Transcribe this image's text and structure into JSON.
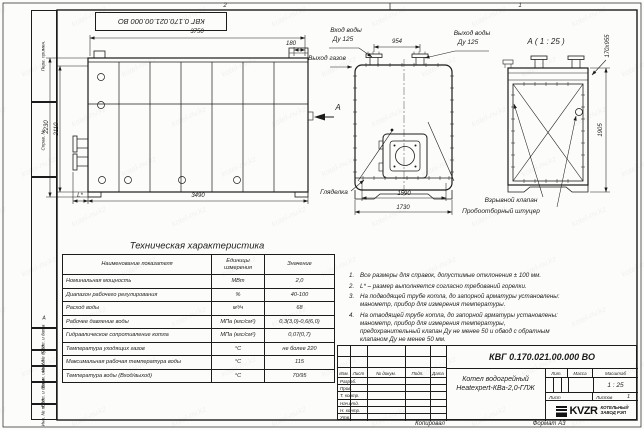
{
  "frame": {
    "top_stamp": "КВГ 0.170.021.00.000 ВО",
    "zone_numbers": [
      "2",
      "1"
    ],
    "zone_letter": "А",
    "left_labels": [
      "Перв. примен.",
      "Справ. №",
      "",
      "Подп. и дата",
      "Инв. № дубл.",
      "Взам. инв. №",
      "Подп. и дата",
      "Инв. № подл."
    ]
  },
  "views": {
    "side": {
      "dim_width_top": "3750",
      "dim_gas_offset": "180",
      "dim_height_outer": "2230",
      "dim_height_inner": "2110",
      "dim_burner": "L*",
      "dim_width_bottom": "3490",
      "view_arrow_label": "А"
    },
    "front": {
      "dim_nozzle_spacing": "954",
      "dim_width_inner": "1590",
      "dim_width_outer": "1730",
      "label_water_inlet": "Вход воды",
      "label_water_inlet_dn": "Ду 125",
      "label_water_outlet": "Выход воды",
      "label_water_outlet_dn": "Ду 125",
      "label_gas_outlet": "Выход газов",
      "label_peephole": "Гляделка",
      "label_explosion_valve": "Взрывной клапан",
      "label_sampling_fitting": "Пробоотборный штуцер"
    },
    "detail_a": {
      "title": "А ( 1 : 25 )",
      "dim_hatch": "170х955",
      "dim_height": "1905"
    }
  },
  "spec_table": {
    "title": "Техническая характеристика",
    "headers": [
      "Наименование показателя",
      "Единицы измерения",
      "Значение"
    ],
    "rows": [
      [
        "Номинальная мощность",
        "МВт",
        "2,0"
      ],
      [
        "Диапазон рабочего регулирования",
        "%",
        "40-100"
      ],
      [
        "Расход воды",
        "м³/ч",
        "68"
      ],
      [
        "Рабочее давление воды",
        "МПа (кгс/см²)",
        "0,3(3,0)-0,6(6,0)"
      ],
      [
        "Гидравлическое сопротивление котла",
        "МПа (кгс/см²)",
        "0,07(0,7)"
      ],
      [
        "Температура уходящих газов",
        "°С",
        "не более 220"
      ],
      [
        "Максимальная рабочая температура воды",
        "°С",
        "115"
      ],
      [
        "Температура воды (Вход/выход)",
        "°С",
        "70/95"
      ]
    ]
  },
  "notes": [
    {
      "num": "1.",
      "text": "Все размеры для справок, допустимые отклонения ± 100 мм."
    },
    {
      "num": "2.",
      "text": "L* – размер выполняется согласно требований горелки."
    },
    {
      "num": "3.",
      "text": "На подводящей трубе котла, до запорной арматуры установлены: манометр, прибор для измерения температуры."
    },
    {
      "num": "4.",
      "text": "На отводящей трубе котла, до запорной арматуры установлены: манометр, прибор для измерения температуры, предохранительный клапан Ду не менее 50 и обвод с обратным клапаном Ду не менее 50 мм."
    }
  ],
  "title_block": {
    "doc_number": "КВГ 0.170.021.00.000 ВО",
    "product_name": "Котел водогрейный",
    "product_model": "Heatexpert-КВа-2,0-ГЛЖ",
    "revision_headers": [
      "Изм.",
      "Лист",
      "№ докум.",
      "Подп.",
      "Дата"
    ],
    "signature_rows": [
      "Разраб.",
      "Пров.",
      "Т. контр.",
      "Нач.отд.",
      "Н. контр.",
      "Утв."
    ],
    "lit_label": "Лит.",
    "mass_label": "Масса",
    "scale_label": "Масштаб",
    "scale_value": "1 : 25",
    "sheet_label": "Лист",
    "sheets_label": "Листов",
    "sheets_value": "1",
    "logo_text": "KVZR",
    "logo_caption_line1": "КОТЕЛЬНЫЙ",
    "logo_caption_line2": "ЗАВОД РЭП",
    "copied_label": "Копировал",
    "format_label": "Формат А3"
  },
  "watermark": {
    "text": "kotel-nv.kz"
  }
}
